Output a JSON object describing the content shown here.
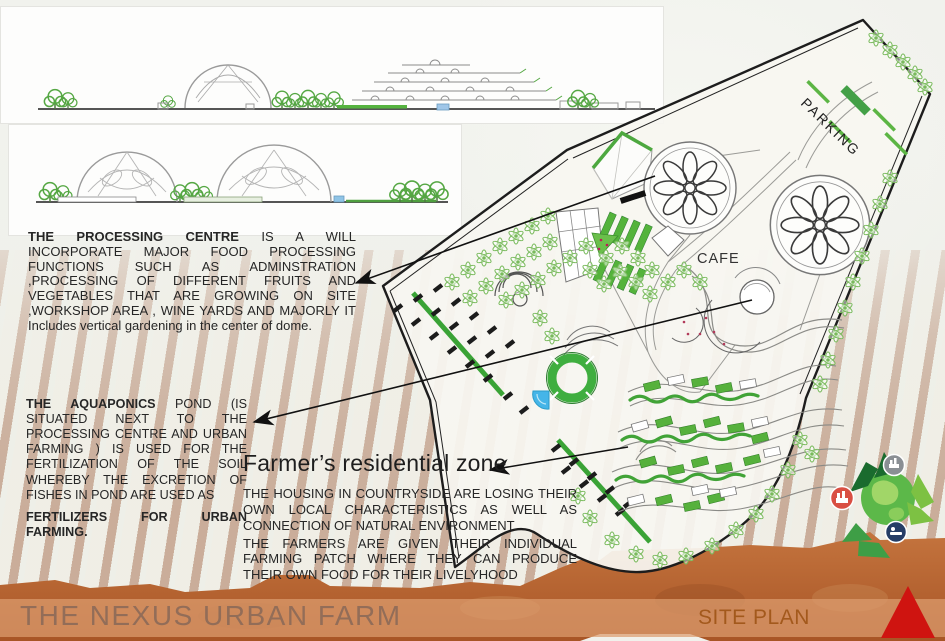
{
  "colors": {
    "site_line": "#1d1d1d",
    "tree_green": "#79ba5c",
    "bed_green": "#54b33b",
    "strip_green": "#3aa336",
    "water_blue": "#45b5e8",
    "soil_brown": "#b4602d",
    "band_brown": "#dc9d6f",
    "footer_title_color": "#8d6a58",
    "site_plan_label_color": "#a3591c",
    "triangle_red": "#cf1410"
  },
  "annotations": {
    "processing": {
      "lead": "THE PROCESSING CENTRE",
      "body": " IS A WILL INCORPORATE MAJOR FOOD PROCESSING FUNCTIONS SUCH AS ADMINSTRATION ,PROCESSING OF DIFFERENT FRUITS AND VEGETABLES THAT ARE GROWING ON SITE ,WORKSHOP AREA , WINE YARDS AND MAJORLY IT Includes vertical gardening in the center of dome."
    },
    "aquaponics": {
      "lead": "THE AQUAPONICS",
      "body": " POND (IS SITUATED NEXT TO THE PROCESSING CENTRE AND URBAN FARMING ) IS USED FOR THE FERTILIZATION OF THE SOIL WHEREBY THE EXCRETION OF FISHES IN POND ARE USED AS",
      "body2": "FERTILIZERS FOR URBAN FARMING."
    },
    "farmer": {
      "heading": "Farmer’s residential zone",
      "para1": "THE HOUSING IN COUNTRYSIDE ARE LOSING THEIR OWN LOCAL CHARACTERISTICS AS WELL AS CONNECTION OF NATURAL ENVIRONMENT.",
      "para2": "THE FARMERS ARE GIVEN THEIR INDIVIDUAL FARMING PATCH WHERE THEY CAN PRODUCE THEIR OWN FOOD FOR THEIR LIVELYHOOD"
    }
  },
  "site_plan": {
    "parking_label": "PARKING",
    "cafe_label": "CAFE"
  },
  "footer": {
    "title": "THE NEXUS URBAN FARM",
    "plan_label": "SITE PLAN"
  }
}
